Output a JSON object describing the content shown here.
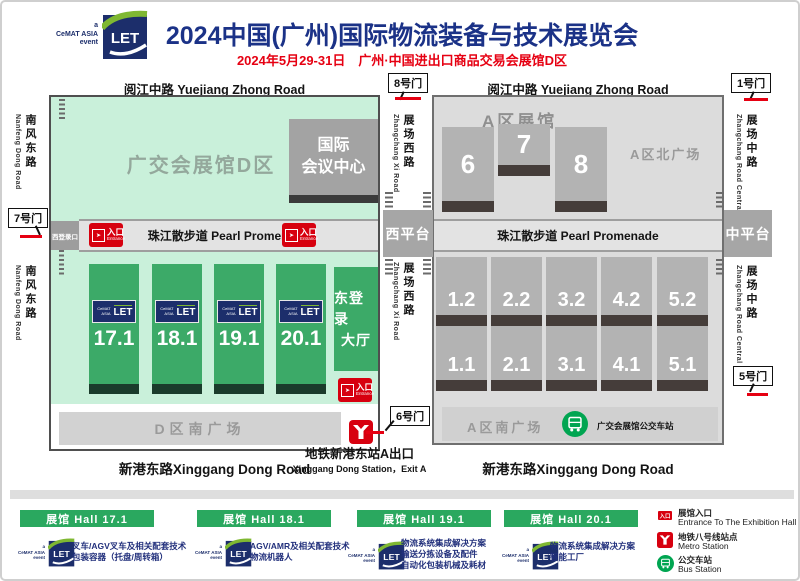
{
  "colors": {
    "title_navy": "#1b3287",
    "accent_red": "#e60012",
    "badge_red": "#d7000f",
    "mint": "#c9f0da",
    "hall_green": "#3caa68",
    "banner_green": "#2aa85f",
    "bus_green": "#00a551",
    "map_gray": "#dcdcdc",
    "hall_gray": "#b3b3b3",
    "logo_navy": "#1c2e6b"
  },
  "header": {
    "logo": {
      "a": "a",
      "cemat": "CeMAT ASIA",
      "event": "event",
      "let": "LET"
    },
    "title": "2024中国(广州)国际物流装备与技术展览会",
    "subtitle": "2024年5月29-31日　广州·中国进出口商品交易会展馆D区"
  },
  "roads": {
    "yuejiang": "阅江中路  Yuejiang Zhong Road",
    "nanfeng_cn": "南风东路",
    "nanfeng_en": "Nanfeng Dong Road",
    "zhangchang_xi_cn": "展场西路",
    "zhangchang_xi_en": "Zhangchang Xi Road",
    "zhangchang_zhong_cn": "展场中路",
    "zhangchang_zhong_en": "Zhangchang Road Central",
    "xinggang": "新港东路Xinggang Dong Road"
  },
  "gates": {
    "gate1": "1号门",
    "gate5": "5号门",
    "gate6": "6号门",
    "gate7": "7号门",
    "gate8": "8号门"
  },
  "platforms": {
    "west": "西平台",
    "middle": "中平台"
  },
  "promenade": "珠江散步道 Pearl Promenade",
  "entrance_badge": {
    "cn": "入口",
    "en": "Entrance"
  },
  "d_zone": {
    "area_label": "广交会展馆D区",
    "convention_l1": "国际",
    "convention_l2": "会议中心",
    "west_login": "西登录口",
    "halls": [
      "17.1",
      "18.1",
      "19.1",
      "20.1"
    ],
    "east_hall_l1": "东登录",
    "east_hall_l2": "大厅",
    "south_plaza": "D区南广场"
  },
  "a_zone": {
    "area_label": "A区展馆",
    "north_plaza": "A区北广场",
    "top_halls": [
      "6",
      "7",
      "8"
    ],
    "upper_row": [
      "1.2",
      "2.2",
      "3.2",
      "4.2",
      "5.2"
    ],
    "lower_row": [
      "1.1",
      "2.1",
      "3.1",
      "4.1",
      "5.1"
    ],
    "south_plaza": "A区南广场",
    "bus_station": "广交会展馆公交车站"
  },
  "metro_exit": {
    "cn": "地铁新港东站A出口",
    "en": "Xinggang Dong Station，Exit A"
  },
  "legend_halls": [
    {
      "banner": "展馆 Hall 17.1",
      "lines": [
        "叉车/AGV叉车及相关配套技术",
        "包装容器（托盘/周转箱）"
      ]
    },
    {
      "banner": "展馆 Hall 18.1",
      "lines": [
        "AGV/AMR及相关配套技术",
        "物流机器人"
      ]
    },
    {
      "banner": "展馆 Hall 19.1",
      "lines": [
        "物流系统集成解决方案",
        "输送分拣设备及配件",
        "自动化包装机械及耗材"
      ]
    },
    {
      "banner": "展馆 Hall 20.1",
      "lines": [
        "物流系统集成解决方案",
        "智能工厂"
      ]
    }
  ],
  "legend_icons": {
    "entrance_cn": "展馆入口",
    "entrance_en": "Entrance To The Exhibition Hall",
    "metro_cn": "地铁八号线站点",
    "metro_en": "Metro Station",
    "bus_cn": "公交车站",
    "bus_en": "Bus Station"
  }
}
